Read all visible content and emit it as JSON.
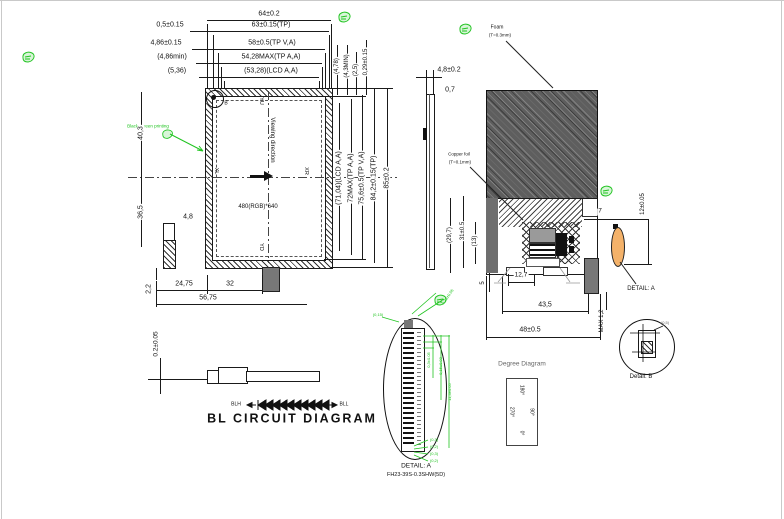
{
  "front": {
    "dim_64": "64±0.2",
    "dim_05": "0,5±0.15",
    "dim_63": "63±0.15(TP)",
    "dim_486": "4,86±0.15",
    "dim_58": "58±0.5(TP V,A)",
    "dim_486min": "(4,86min)",
    "dim_5428": "54,28MAX(TP A,A)",
    "dim_536": "(5,36)",
    "dim_5328": "(53,28)(LCD A,A)",
    "dim_478": "(4,78)",
    "dim_43min": "(4,3MIN)",
    "dim_25": "(2,5)",
    "dim_029": "0,29±0.15",
    "dim_7104": "(71,04)(LCD A,A)",
    "dim_72": "72MAX(TP A,A)",
    "dim_756": "75,6±0.5(TP V,A)",
    "dim_842": "84,2±0.15(TP)",
    "dim_85": "85±0.2",
    "dim_403": "40,3",
    "dim_365": "36,5",
    "dim_48": "4,8",
    "dim_22": "2,2",
    "dim_2475": "24,75",
    "dim_32": "32",
    "dim_5675": "56,75",
    "resolution": "480(RGB)*640",
    "viewing": "Viewing direction",
    "yu": "YU",
    "yd": "YD",
    "xl": "XL",
    "xr": "XR",
    "b": "B",
    "black_print": "Black screen printing"
  },
  "side": {
    "dim_48": "4,8±0.2",
    "dim_07": "0,7"
  },
  "back": {
    "foam": "Foam",
    "foam_t": "(T=0.3mm)",
    "copper": "Copper foil",
    "copper_t": "(T=0.1mm)",
    "dim_297": "(29,7)",
    "dim_31": "31±0.5",
    "dim_13": "(13)",
    "dim_5": "5",
    "dim_7": "7",
    "dim_127": "12,7",
    "dim_435": "43,5",
    "dim_48": "48±0.5",
    "dim_max12": "MAX 1,2",
    "dim_12": "12±0.05",
    "detail_a": "DETAIL: A"
  },
  "bl": {
    "dim": "0.2±0.05",
    "blh": "BLH",
    "bll": "BLL",
    "title": "BL CIRCUIT DIAGRAM",
    "led_count": 10
  },
  "detail_a": {
    "title": "DETAIL: A",
    "part": "FH23-39S-0.3SHW(5D)",
    "dims": [
      "0,3±0.05",
      "0,15±0.03",
      "11,4±0.05",
      "0,28±0.05",
      "(0,15)",
      "(0,3)",
      "(0,2)",
      "(0,3)",
      "(0,2)"
    ]
  },
  "degree": {
    "title": "Degree Diagram",
    "d180": "180°",
    "d270": "270°",
    "d90": "90°",
    "d0": "0°"
  },
  "detail_b": {
    "title": "Detail: B",
    "dim": "(0,5)"
  },
  "colors": {
    "green": "#21c421",
    "foam_gray": "#5e5e5e",
    "fpc_orange": "#f4b26a"
  }
}
